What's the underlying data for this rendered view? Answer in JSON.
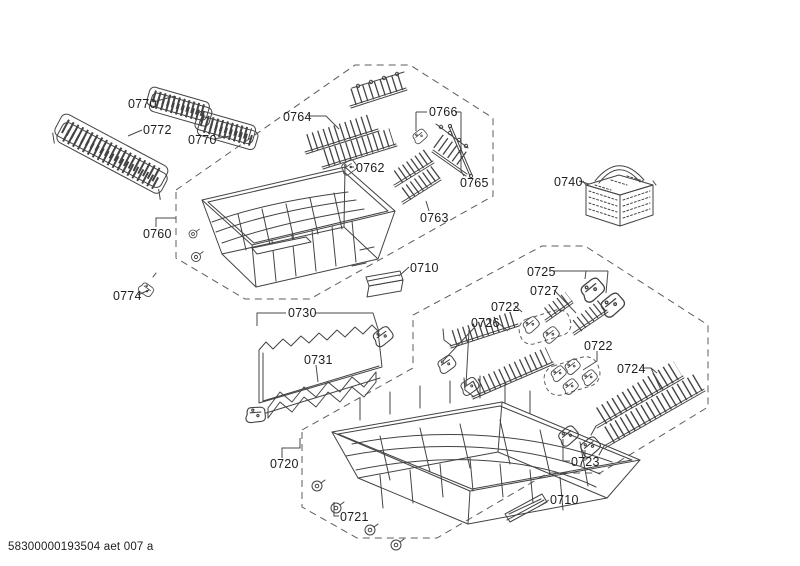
{
  "footer": "58300000193504 aet 007 a",
  "colors": {
    "line": "#434343",
    "dash": "#5c5c5c",
    "label": "#1d1d1d",
    "background": "#ffffff"
  },
  "labels": [
    {
      "id": "0770-top",
      "text": "0770"
    },
    {
      "id": "0772",
      "text": "0772"
    },
    {
      "id": "0770-bottom",
      "text": "0770"
    },
    {
      "id": "0760",
      "text": "0760"
    },
    {
      "id": "0774",
      "text": "0774"
    },
    {
      "id": "0764",
      "text": "0764"
    },
    {
      "id": "0762",
      "text": "0762"
    },
    {
      "id": "0766",
      "text": "0766"
    },
    {
      "id": "0765",
      "text": "0765"
    },
    {
      "id": "0763",
      "text": "0763"
    },
    {
      "id": "0740",
      "text": "0740"
    },
    {
      "id": "0710-upper",
      "text": "0710"
    },
    {
      "id": "0730",
      "text": "0730"
    },
    {
      "id": "0731",
      "text": "0731"
    },
    {
      "id": "0725",
      "text": "0725"
    },
    {
      "id": "0727",
      "text": "0727"
    },
    {
      "id": "0722-upper",
      "text": "0722"
    },
    {
      "id": "0726",
      "text": "0726"
    },
    {
      "id": "0722-lower",
      "text": "0722"
    },
    {
      "id": "0724",
      "text": "0724"
    },
    {
      "id": "0720",
      "text": "0720"
    },
    {
      "id": "0721",
      "text": "0721"
    },
    {
      "id": "0723",
      "text": "0723"
    },
    {
      "id": "0710-lower",
      "text": "0710"
    }
  ]
}
